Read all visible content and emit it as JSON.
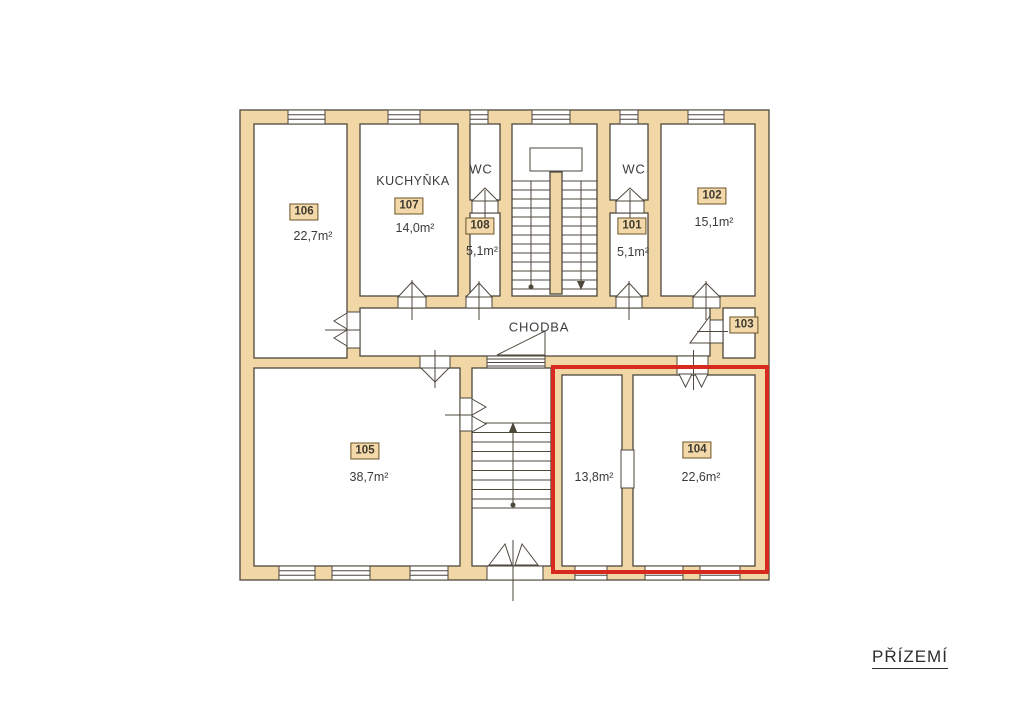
{
  "title": "PŘÍZEMÍ",
  "areas": {
    "corridor": "CHODBA",
    "kitchen": "KUCHYŇKA",
    "wc_left": "WC",
    "wc_right": "WC"
  },
  "rooms": {
    "r101": {
      "number": "101",
      "area": "5,1m²"
    },
    "r102": {
      "number": "102",
      "area": "15,1m²"
    },
    "r103": {
      "number": "103"
    },
    "r104": {
      "number": "104",
      "area": "22,6m²",
      "highlighted": true
    },
    "r105": {
      "number": "105",
      "area": "38,7m²"
    },
    "r106": {
      "number": "106",
      "area": "22,7m²"
    },
    "r107": {
      "number": "107",
      "area": "14,0m²"
    },
    "r108": {
      "number": "108",
      "area": "5,1m²"
    },
    "r_small": {
      "area": "13,8m²",
      "highlighted": true
    }
  },
  "colors": {
    "wall": "#f1d7a6",
    "line": "#4d473c",
    "highlight": "#d8291f",
    "label_box_bg": "#f3d9a9",
    "label_box_border": "#6b5327"
  }
}
